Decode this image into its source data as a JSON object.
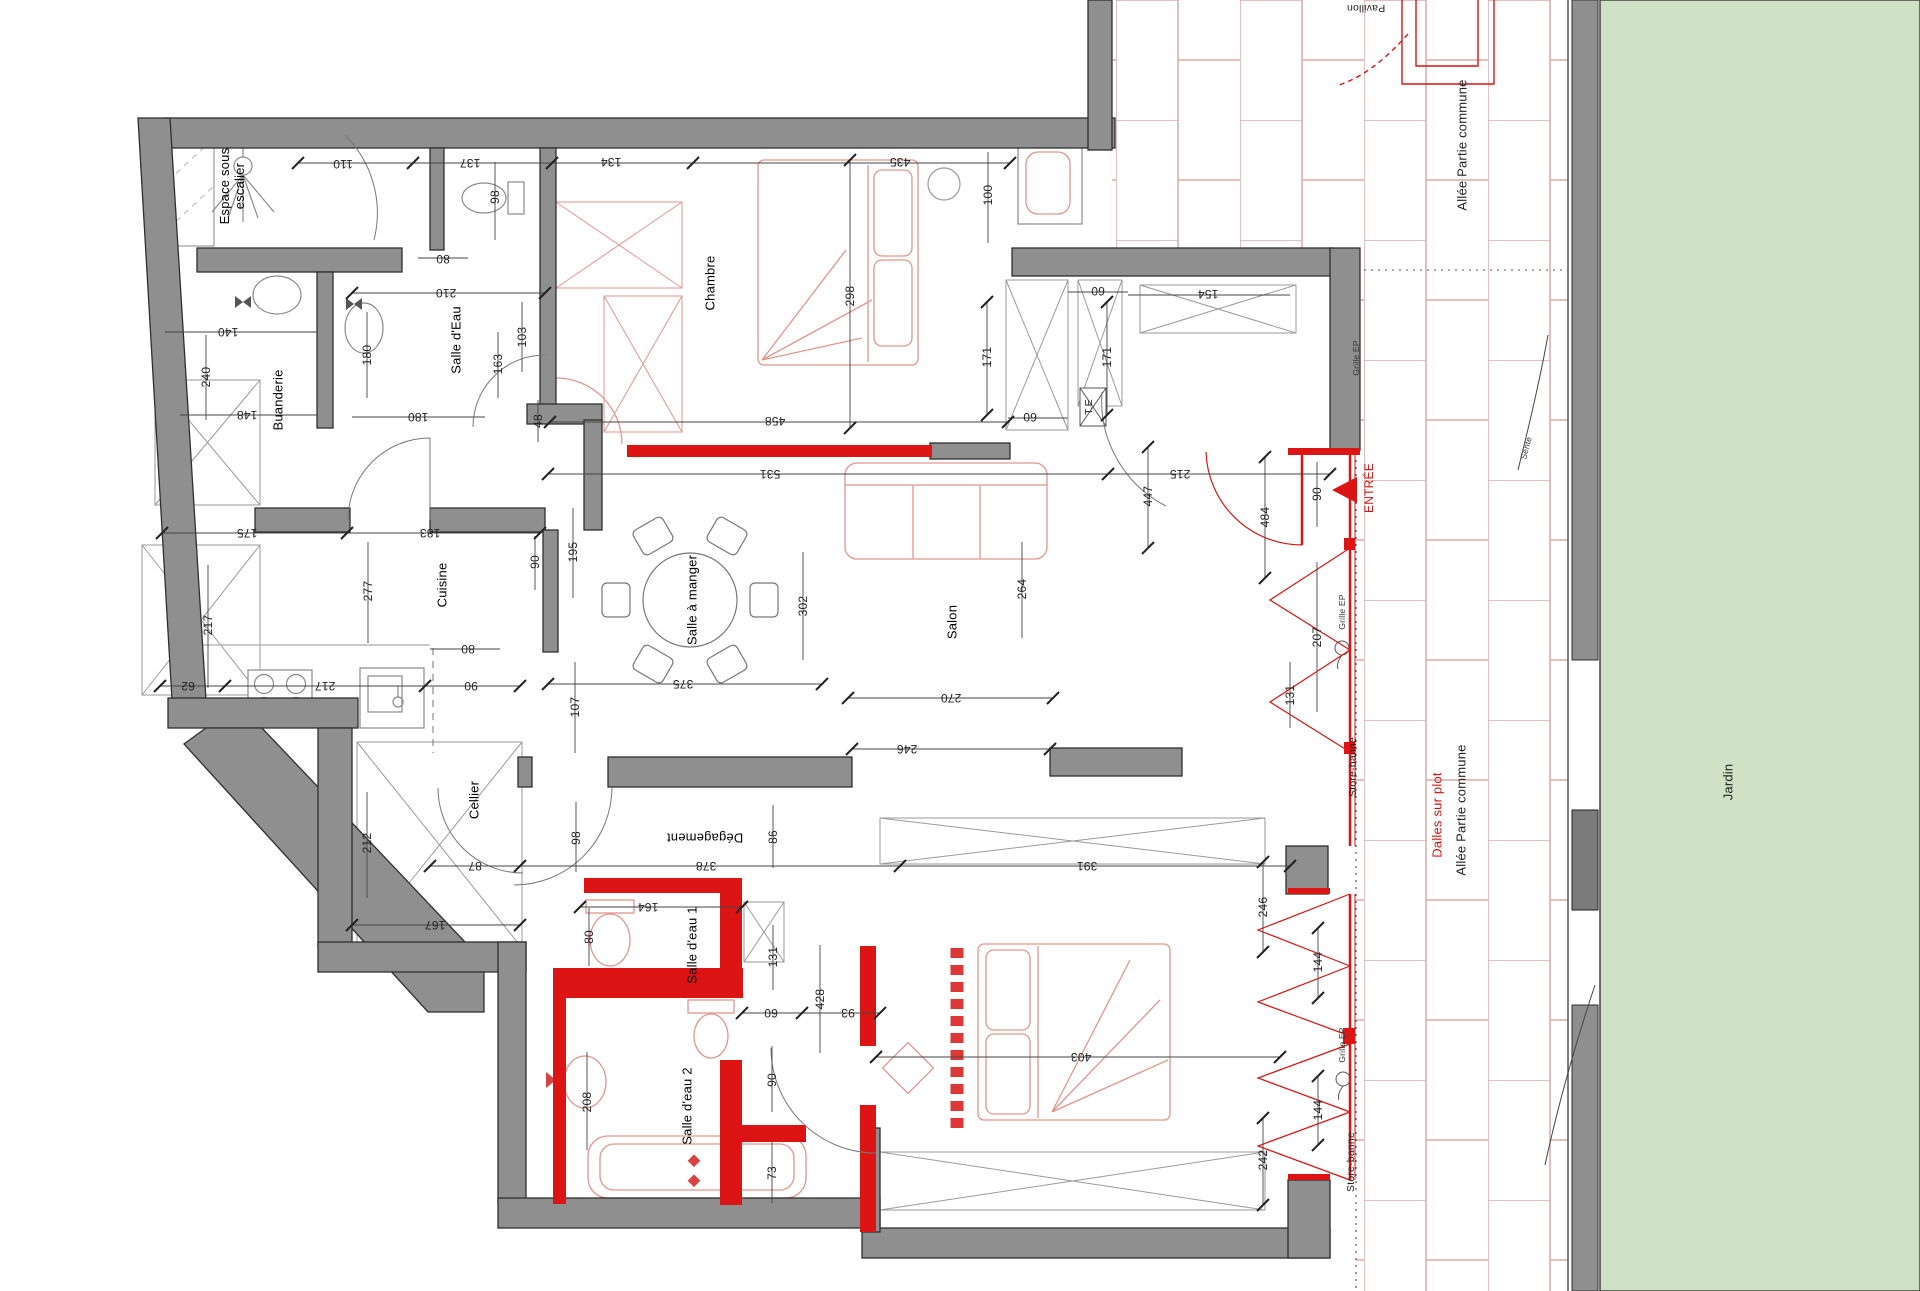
{
  "colors": {
    "wall_gray": "#8f8f8f",
    "wall_edge": "#2f2f2f",
    "accent_red": "#dd1414",
    "furniture_pink": "#e2968e",
    "tile_joint": "#dcaaa8",
    "garden_green": "#cfe2c6",
    "dim_text": "#222222"
  },
  "rooms": {
    "espace_sous_escalier": "Espace sous escalier",
    "salle_eau": "Salle d'Eau",
    "buanderie": "Buanderie",
    "chambre": "Chambre",
    "cuisine": "Cuisine",
    "salle_a_manger": "Salle à manger",
    "salon": "Salon",
    "cellier": "Cellier",
    "degagement": "Dégagement",
    "salle_eau_1": "Salle d'eau 1",
    "salle_eau_2": "Salle d'eau 2"
  },
  "annots": {
    "entree": "ENTRÉE",
    "te": "T.E",
    "pavillon": "Pavillon",
    "allee_partie_commune": "Allée Partie commune",
    "dalles_sur_plot": "Dalles sur plot",
    "jardin": "Jardin",
    "sente": "Sente",
    "grille_ep": "Grille EP",
    "store_banne": "Store-banne"
  },
  "dims": [
    "110",
    "137",
    "134",
    "435",
    "100",
    "98",
    "80",
    "210",
    "140",
    "240",
    "148",
    "180",
    "48",
    "163",
    "103",
    "180",
    "175",
    "183",
    "298",
    "458",
    "60",
    "171",
    "171",
    "60",
    "154",
    "531",
    "215",
    "447",
    "484",
    "90",
    "207",
    "264",
    "302",
    "195",
    "90",
    "277",
    "217",
    "62",
    "217",
    "90",
    "80",
    "375",
    "107",
    "270",
    "246",
    "131",
    "212",
    "167",
    "87",
    "98",
    "378",
    "86",
    "391",
    "164",
    "80",
    "131",
    "428",
    "93",
    "60",
    "90",
    "208",
    "73",
    "246",
    "144",
    "144",
    "242",
    "403"
  ]
}
